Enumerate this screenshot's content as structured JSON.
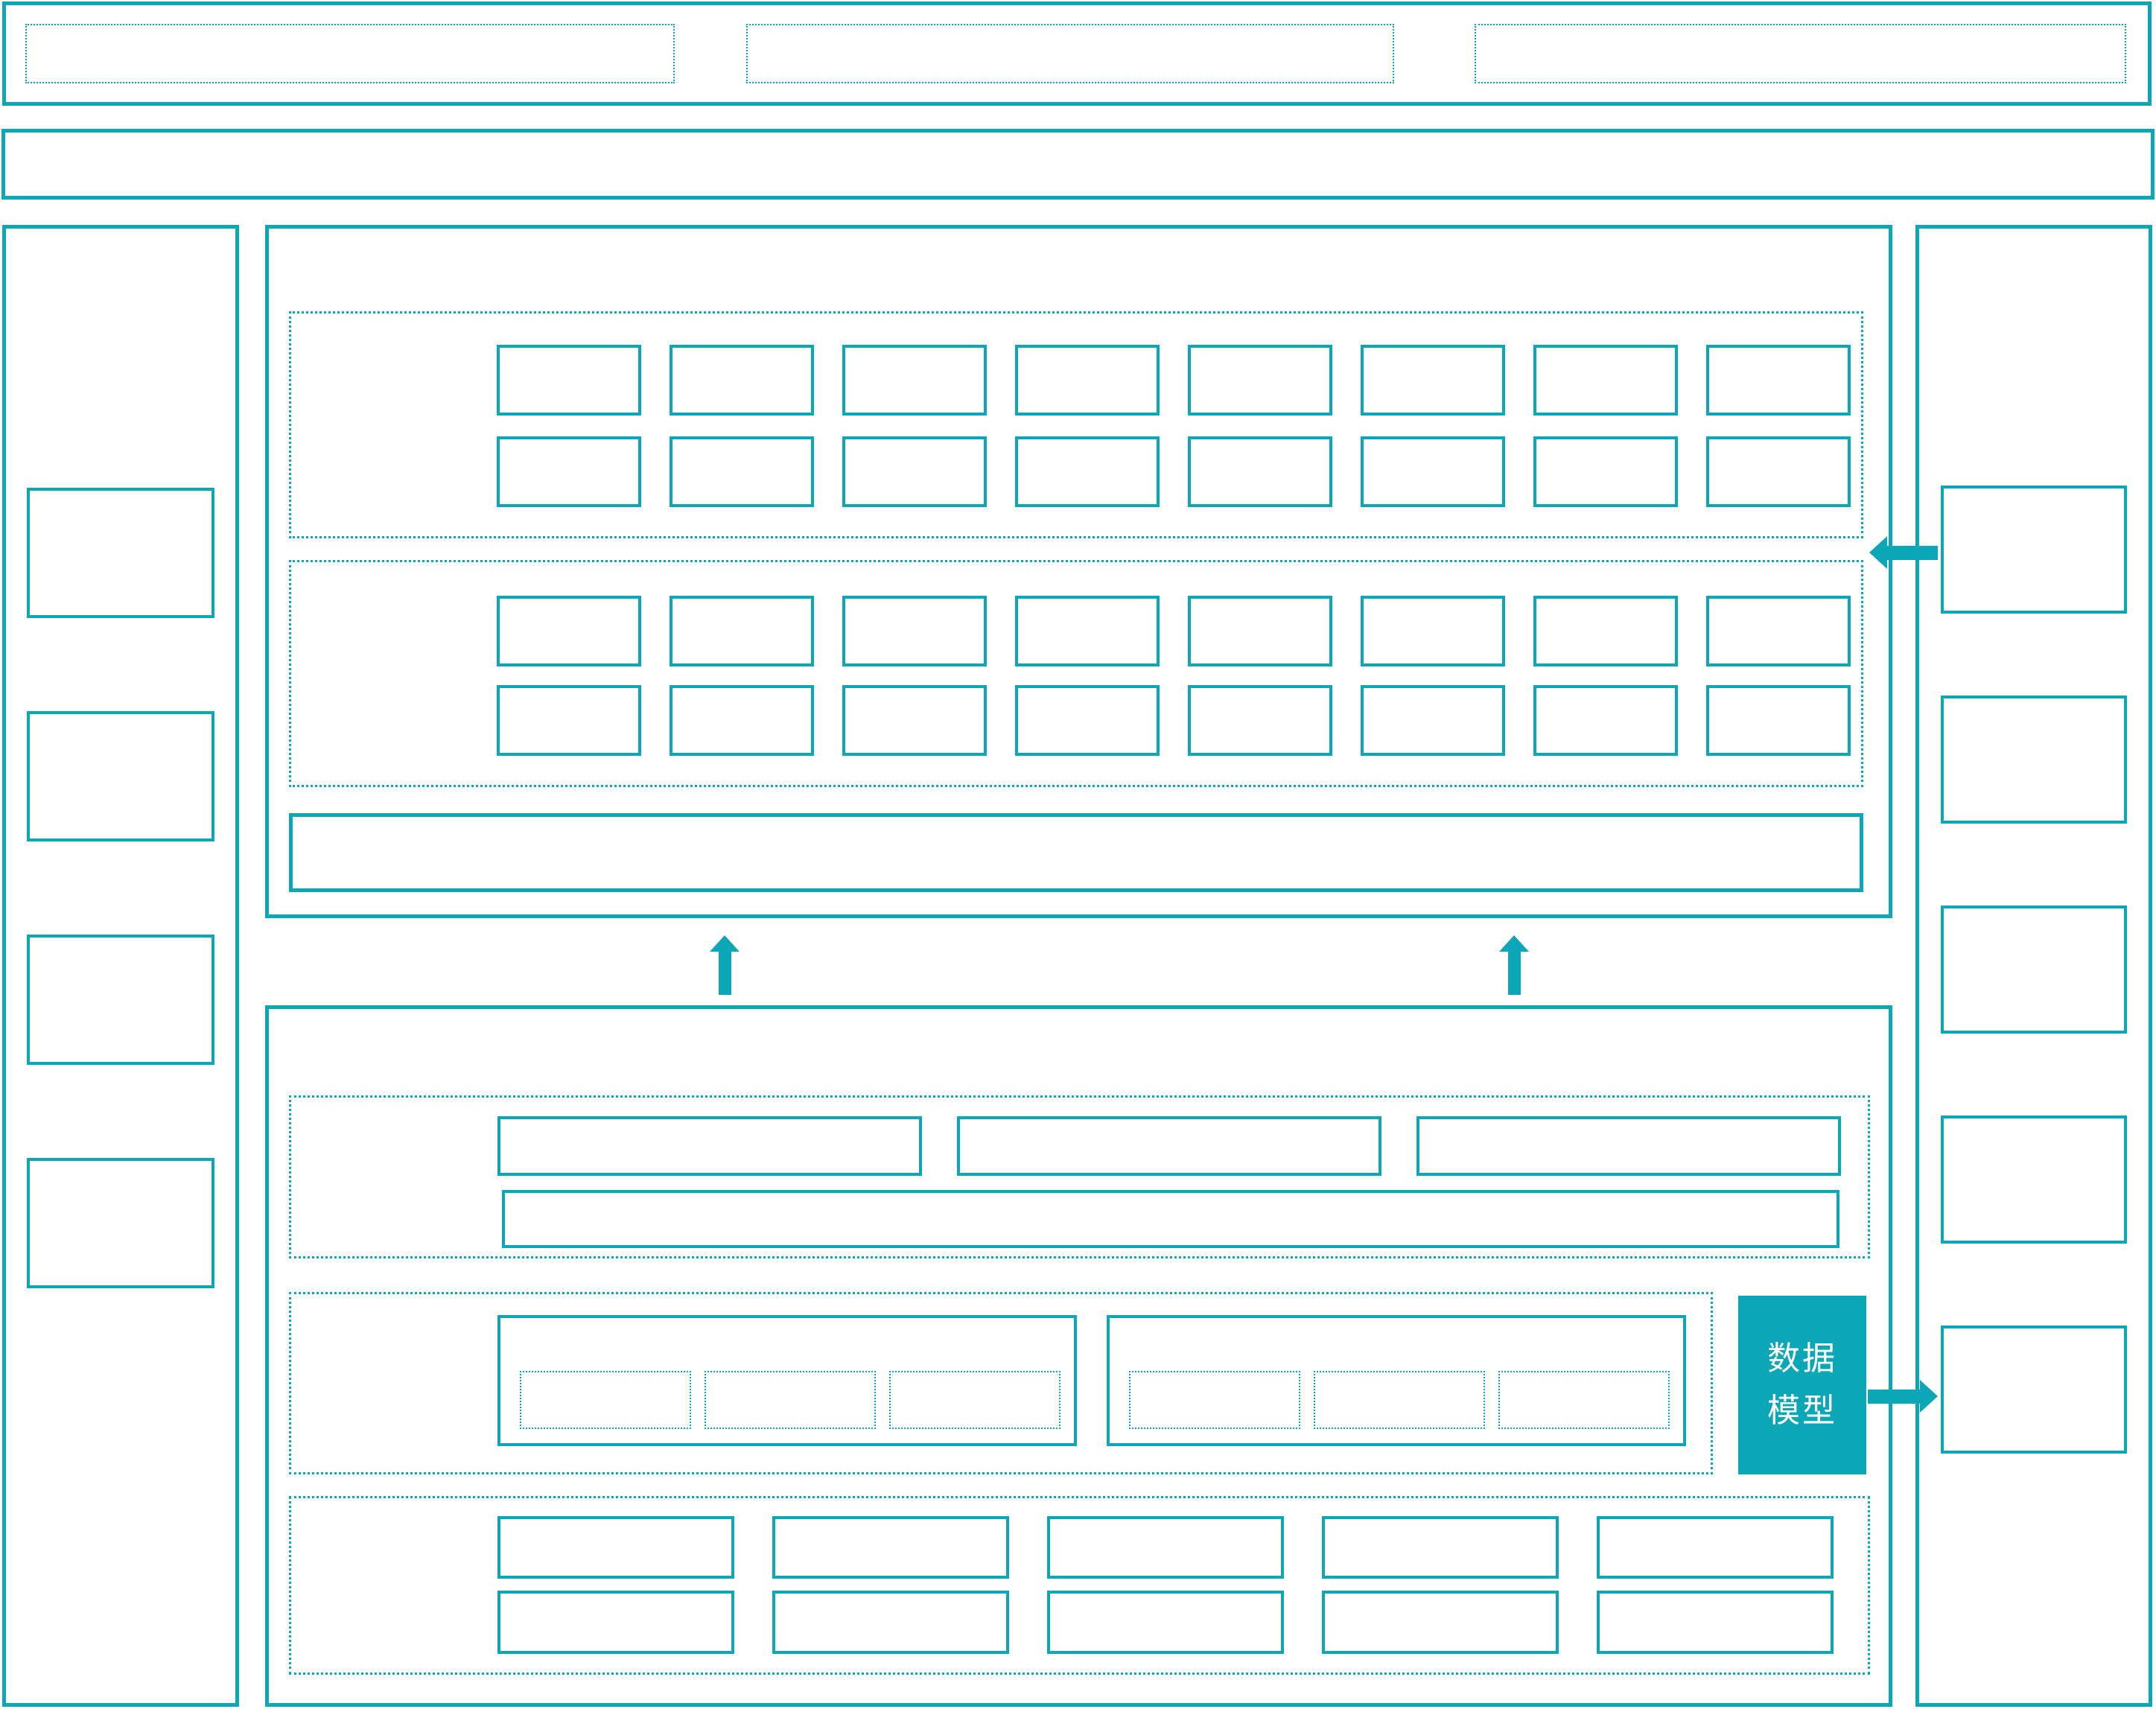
{
  "diagram": {
    "accent_color": "#0ba7b6",
    "background_color": "#ffffff"
  },
  "header_bar": {
    "slot_count": 3
  },
  "banner_bar": {},
  "left_sidebar": {
    "item_count": 4
  },
  "right_sidebar": {
    "item_count": 5
  },
  "upper_panel": {
    "group1": {
      "rows": 2,
      "cells_per_row": 8
    },
    "group2": {
      "rows": 2,
      "cells_per_row": 8
    },
    "wide_bar": 1
  },
  "lower_panel": {
    "group_a": {
      "wide_box_count": 3,
      "full_bar_count": 1
    },
    "group_b": {
      "cluster_count": 2,
      "cells_per_cluster": 3,
      "data_model": {
        "label": "数据模型",
        "fill": "#0ba7b6",
        "text_color": "#ffffff"
      }
    },
    "group_c": {
      "rows": 2,
      "cells_per_row": 5
    }
  },
  "arrows": {
    "up_count": 2,
    "left_count": 1,
    "right_count": 1
  }
}
